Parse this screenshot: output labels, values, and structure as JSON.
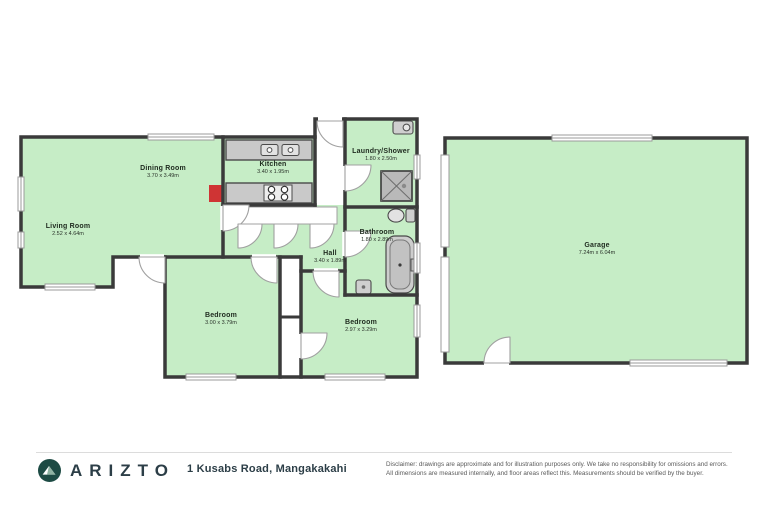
{
  "footer": {
    "brand": "ARIZTO",
    "address": "1 Kusabs Road, Mangakakahi",
    "disclaimer_line1": "Disclaimer: drawings are approximate and for illustration purposes only. We take no responsibility for omissions and errors.",
    "disclaimer_line2": "All dimensions are measured internally, and floor areas reflect this. Measurements should be verified by the buyer."
  },
  "rooms": [
    {
      "id": "living",
      "name": "Living Room",
      "dims": "2.52 x 4.64m"
    },
    {
      "id": "dining",
      "name": "Dining Room",
      "dims": "3.70 x 3.49m"
    },
    {
      "id": "kitchen",
      "name": "Kitchen",
      "dims": "3.40 x 1.95m"
    },
    {
      "id": "laundry",
      "name": "Laundry/Shower",
      "dims": "1.80 x 2.50m"
    },
    {
      "id": "bathroom",
      "name": "Bathroom",
      "dims": "1.80 x 2.89m"
    },
    {
      "id": "hall",
      "name": "Hall",
      "dims": "3.40 x 1.89m"
    },
    {
      "id": "bedroom1",
      "name": "Bedroom",
      "dims": "3.00 x 3.79m"
    },
    {
      "id": "bedroom2",
      "name": "Bedroom",
      "dims": "2.97 x 3.29m"
    },
    {
      "id": "garage",
      "name": "Garage",
      "dims": "7.24m x 6.04m"
    }
  ],
  "colors": {
    "room_fill": "#c6edc6",
    "wall": "#3a3a3a",
    "marker_red": "#cf3434",
    "fixture_gray": "#cdcdcd",
    "door_line": "#a0a0a0",
    "logo_circle": "#1d4b44",
    "brand_text": "#2c3e47"
  }
}
